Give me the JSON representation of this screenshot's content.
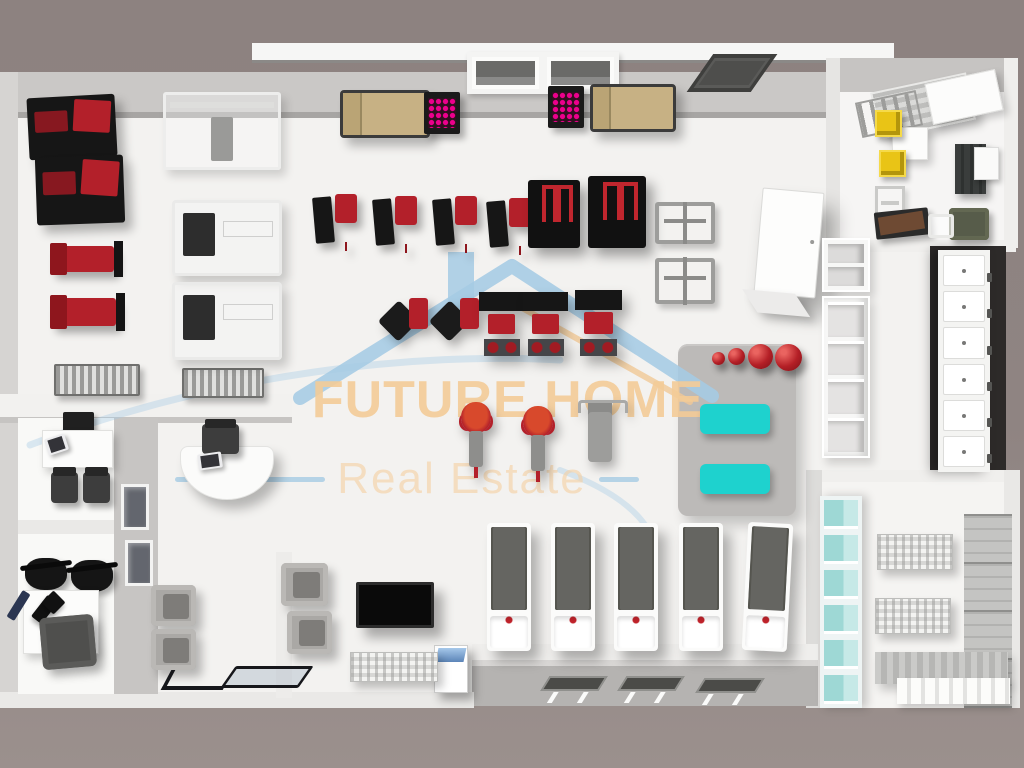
{
  "watermark": {
    "brand": "FUTURE HOME",
    "tagline": "Real Estate",
    "brand_color": "#f3cb97",
    "tagline_color": "#f3d1a3",
    "accent_blue": "#a5cbe4",
    "roof_orange": "#f0c896"
  },
  "palette": {
    "background": "#8f8482",
    "floor": "#f3f2f0",
    "wall": "#cac8c6",
    "machine_red": "#b3202a",
    "machine_black": "#161616",
    "sofa_tan": "#c7b184",
    "rack_pink": "#ec008c",
    "mat_teal": "#1ed2ce",
    "ball_red": "#b41f26",
    "locker_white": "#f4f4f2",
    "bin_yellow": "#e9c416"
  },
  "items": [
    {
      "k": "rect",
      "n": "top-wall",
      "x": 0,
      "y": 72,
      "w": 838,
      "h": 46,
      "c": "#cac8c6"
    },
    {
      "k": "rect",
      "n": "top-wall-edge",
      "x": 18,
      "y": 112,
      "w": 820,
      "h": 7,
      "c": "#a7a5a3"
    },
    {
      "k": "rect",
      "n": "roof-beam",
      "x": 252,
      "y": 43,
      "w": 642,
      "h": 17,
      "c": "#f6f6f5"
    },
    {
      "k": "rect",
      "n": "roof-beam-line",
      "x": 252,
      "y": 60,
      "w": 642,
      "h": 3,
      "c": "#8b8987"
    },
    {
      "k": "rect",
      "n": "left-wall",
      "x": 0,
      "y": 72,
      "w": 18,
      "h": 632,
      "c": "#d6d4d2"
    },
    {
      "k": "rect",
      "n": "main-floor",
      "x": 18,
      "y": 118,
      "w": 988,
      "h": 588,
      "c": "#f3f2f0"
    },
    {
      "k": "rect",
      "n": "office-top-wall",
      "x": 838,
      "y": 58,
      "w": 176,
      "h": 34,
      "c": "#c6c4c2"
    },
    {
      "k": "rect",
      "n": "office-left-wall",
      "x": 826,
      "y": 58,
      "w": 14,
      "h": 190,
      "c": "#e6e5e3"
    },
    {
      "k": "rect",
      "n": "office-floor",
      "x": 840,
      "y": 92,
      "w": 164,
      "h": 148,
      "c": "#f6f5f4"
    },
    {
      "k": "rect",
      "n": "office-right-wall",
      "x": 1004,
      "y": 58,
      "w": 14,
      "h": 190,
      "c": "#efeeec"
    },
    {
      "k": "rect",
      "n": "office-bottom-wall",
      "x": 826,
      "y": 240,
      "w": 190,
      "h": 12,
      "c": "#f0efed"
    },
    {
      "k": "rect",
      "n": "locker-backdrop",
      "x": 930,
      "y": 246,
      "w": 76,
      "h": 228,
      "c": "#2d2a29"
    },
    {
      "k": "rect",
      "n": "changing-left-wall",
      "x": 806,
      "y": 470,
      "w": 16,
      "h": 238,
      "c": "#dddcda"
    },
    {
      "k": "rect",
      "n": "changing-top-wall",
      "x": 822,
      "y": 470,
      "w": 182,
      "h": 12,
      "c": "#f0efed"
    },
    {
      "k": "rect",
      "n": "changing-floor",
      "x": 822,
      "y": 482,
      "w": 182,
      "h": 226,
      "c": "#f5f4f2"
    },
    {
      "k": "rect",
      "n": "changing-right-wall",
      "x": 1004,
      "y": 470,
      "w": 16,
      "h": 238,
      "c": "#e9e8e6"
    },
    {
      "k": "rect",
      "n": "hall-bottom-band",
      "x": 472,
      "y": 644,
      "w": 346,
      "h": 18,
      "c": "#efeeec"
    },
    {
      "k": "rect",
      "n": "recessed-strip",
      "x": 472,
      "y": 660,
      "w": 346,
      "h": 46,
      "c": "#b5b3b1"
    },
    {
      "k": "rect",
      "n": "recessed-strip-bevel",
      "x": 472,
      "y": 660,
      "w": 346,
      "h": 6,
      "c": "#d9d7d5"
    },
    {
      "k": "rect",
      "n": "bottom-ledge",
      "x": 0,
      "y": 692,
      "w": 474,
      "h": 16,
      "c": "#eae9e7"
    },
    {
      "k": "rect",
      "n": "partition-band",
      "x": 0,
      "y": 394,
      "w": 292,
      "h": 24,
      "c": "#f2f1ef"
    },
    {
      "k": "rect",
      "n": "partition-band-shadow",
      "x": 0,
      "y": 417,
      "w": 292,
      "h": 6,
      "c": "#c6c4c2"
    },
    {
      "k": "rect",
      "n": "office-rooms-floor",
      "x": 18,
      "y": 418,
      "w": 96,
      "h": 276,
      "c": "#f9f9f7"
    },
    {
      "k": "rect",
      "n": "glass-wall",
      "x": 114,
      "y": 418,
      "w": 44,
      "h": 276,
      "c": "#c7c5c3"
    },
    {
      "k": "rect",
      "n": "rooms-divider-wall",
      "x": 18,
      "y": 520,
      "w": 96,
      "h": 14,
      "c": "#eae9e7"
    },
    {
      "k": "rect",
      "n": "lounge-wall",
      "x": 276,
      "y": 552,
      "w": 16,
      "h": 146,
      "c": "#edecea"
    },
    {
      "k": "bench-machine",
      "n": "incline-press-machine-1",
      "x": 28,
      "y": 96,
      "w": 88,
      "h": 62,
      "r": -3
    },
    {
      "k": "bench-machine",
      "n": "incline-press-machine-2",
      "x": 36,
      "y": 156,
      "w": 88,
      "h": 68,
      "r": -2
    },
    {
      "k": "bench-red",
      "n": "flat-bench-1",
      "x": 50,
      "y": 246,
      "w": 64,
      "h": 26
    },
    {
      "k": "bench-red",
      "n": "flat-bench-2",
      "x": 50,
      "y": 298,
      "w": 66,
      "h": 28
    },
    {
      "k": "db-rack",
      "n": "dumbbell-rack-1",
      "x": 54,
      "y": 364,
      "w": 86,
      "h": 32
    },
    {
      "k": "db-rack",
      "n": "dumbbell-rack-2",
      "x": 182,
      "y": 368,
      "w": 82,
      "h": 30
    },
    {
      "k": "multi-station",
      "n": "cable-crossover-station",
      "x": 163,
      "y": 92,
      "w": 118,
      "h": 78
    },
    {
      "k": "white-machine",
      "n": "plate-loaded-machine-1",
      "x": 172,
      "y": 200,
      "w": 110,
      "h": 76
    },
    {
      "k": "white-machine",
      "n": "plate-loaded-machine-2",
      "x": 172,
      "y": 282,
      "w": 110,
      "h": 78
    },
    {
      "k": "sofa-tan",
      "n": "lounge-sofa-1",
      "x": 340,
      "y": 90,
      "w": 90,
      "h": 48
    },
    {
      "k": "pink-rack",
      "n": "pink-dumbbell-rack-1",
      "x": 424,
      "y": 92,
      "w": 36,
      "h": 42
    },
    {
      "k": "window-top",
      "n": "top-wall-window",
      "x": 467,
      "y": 52,
      "w": 152,
      "h": 42,
      "cells": 2
    },
    {
      "k": "pink-rack",
      "n": "pink-dumbbell-rack-2",
      "x": 548,
      "y": 86,
      "w": 36,
      "h": 42
    },
    {
      "k": "sofa-tan",
      "n": "lounge-sofa-2",
      "x": 590,
      "y": 84,
      "w": 86,
      "h": 48
    },
    {
      "k": "vent",
      "n": "ceiling-vent",
      "x": 700,
      "y": 54,
      "w": 64,
      "h": 38
    },
    {
      "k": "machine-red-seat",
      "n": "selectorized-machine-1",
      "x": 314,
      "y": 194,
      "w": 46,
      "h": 56
    },
    {
      "k": "machine-red-seat",
      "n": "selectorized-machine-2",
      "x": 374,
      "y": 196,
      "w": 46,
      "h": 56
    },
    {
      "k": "machine-red-seat",
      "n": "selectorized-machine-3",
      "x": 434,
      "y": 196,
      "w": 46,
      "h": 56
    },
    {
      "k": "machine-red-seat",
      "n": "selectorized-machine-4",
      "x": 488,
      "y": 198,
      "w": 46,
      "h": 56
    },
    {
      "k": "machine-black",
      "n": "lat-pulldown-machine",
      "x": 528,
      "y": 180,
      "w": 52,
      "h": 68
    },
    {
      "k": "machine-black",
      "n": "assisted-dip-machine",
      "x": 588,
      "y": 176,
      "w": 58,
      "h": 72
    },
    {
      "k": "fly-machine",
      "n": "pec-fly-machine-1",
      "x": 381,
      "y": 296,
      "w": 52,
      "h": 54
    },
    {
      "k": "fly-machine",
      "n": "pec-fly-machine-2",
      "x": 432,
      "y": 296,
      "w": 52,
      "h": 54
    },
    {
      "k": "rack-bench",
      "n": "squat-rack-bench-1",
      "x": 479,
      "y": 292,
      "w": 45,
      "h": 64
    },
    {
      "k": "rack-bench",
      "n": "squat-rack-bench-2",
      "x": 523,
      "y": 292,
      "w": 45,
      "h": 64
    },
    {
      "k": "rack-bench",
      "n": "squat-rack-bench-3",
      "x": 575,
      "y": 290,
      "w": 47,
      "h": 66
    },
    {
      "k": "pullup-frame",
      "n": "pullup-frame-1",
      "x": 655,
      "y": 202,
      "w": 60,
      "h": 42
    },
    {
      "k": "pullup-frame",
      "n": "pullup-frame-2",
      "x": 655,
      "y": 258,
      "w": 60,
      "h": 46
    },
    {
      "k": "wardrobe-white",
      "n": "storage-cabinet-white",
      "x": 758,
      "y": 190,
      "w": 62,
      "h": 106,
      "r": 5
    },
    {
      "k": "shelf-open-upper",
      "n": "wall-shelf-upper",
      "x": 822,
      "y": 238,
      "w": 48,
      "h": 54,
      "cells": 2
    },
    {
      "k": "shelf-open",
      "n": "open-shelf-unit",
      "x": 822,
      "y": 296,
      "w": 48,
      "h": 162,
      "cells": 4
    },
    {
      "k": "platform",
      "n": "stretching-platform",
      "x": 678,
      "y": 344,
      "w": 118,
      "h": 172,
      "z": 4
    },
    {
      "k": "ball-red",
      "n": "medicine-ball-small-1",
      "x": 712,
      "y": 352,
      "w": 13,
      "h": 13
    },
    {
      "k": "ball-red",
      "n": "medicine-ball-small-2",
      "x": 728,
      "y": 348,
      "w": 17,
      "h": 17
    },
    {
      "k": "ball-red",
      "n": "exercise-ball-large-1",
      "x": 748,
      "y": 344,
      "w": 25,
      "h": 25
    },
    {
      "k": "ball-red",
      "n": "exercise-ball-large-2",
      "x": 775,
      "y": 344,
      "w": 27,
      "h": 27
    },
    {
      "k": "teal-mat",
      "n": "exercise-mat-teal-1",
      "x": 700,
      "y": 404,
      "w": 70,
      "h": 30
    },
    {
      "k": "teal-mat",
      "n": "exercise-mat-teal-2",
      "x": 700,
      "y": 464,
      "w": 70,
      "h": 30
    },
    {
      "k": "spin-bike",
      "n": "spin-bike-1",
      "x": 454,
      "y": 402,
      "w": 44,
      "h": 68
    },
    {
      "k": "spin-bike",
      "n": "spin-bike-2",
      "x": 516,
      "y": 406,
      "w": 44,
      "h": 68
    },
    {
      "k": "elliptical",
      "n": "elliptical-trainer",
      "x": 576,
      "y": 398,
      "w": 48,
      "h": 84
    },
    {
      "k": "treadmill",
      "n": "treadmill-1",
      "x": 487,
      "y": 523,
      "w": 44,
      "h": 128
    },
    {
      "k": "treadmill",
      "n": "treadmill-2",
      "x": 551,
      "y": 523,
      "w": 44,
      "h": 128
    },
    {
      "k": "treadmill",
      "n": "treadmill-3",
      "x": 614,
      "y": 523,
      "w": 44,
      "h": 128
    },
    {
      "k": "treadmill",
      "n": "treadmill-4",
      "x": 679,
      "y": 523,
      "w": 44,
      "h": 128
    },
    {
      "k": "treadmill",
      "n": "treadmill-5",
      "x": 745,
      "y": 523,
      "w": 45,
      "h": 128,
      "r": 3
    },
    {
      "k": "mat-dark",
      "n": "floor-mat-dark-1",
      "x": 545,
      "y": 676,
      "w": 58,
      "h": 15
    },
    {
      "k": "mat-dark",
      "n": "floor-mat-dark-2",
      "x": 622,
      "y": 676,
      "w": 58,
      "h": 15
    },
    {
      "k": "mat-dark",
      "n": "floor-mat-dark-3",
      "x": 700,
      "y": 678,
      "w": 60,
      "h": 15
    },
    {
      "k": "kiosk",
      "n": "check-in-kiosk",
      "x": 434,
      "y": 645,
      "w": 34,
      "h": 48
    },
    {
      "k": "striped",
      "n": "striped-bench-hall",
      "x": 350,
      "y": 652,
      "w": 88,
      "h": 30
    },
    {
      "k": "tv",
      "n": "wall-tv",
      "x": 356,
      "y": 582,
      "w": 78,
      "h": 46
    },
    {
      "k": "armchair-gray",
      "n": "waiting-armchair-1",
      "x": 151,
      "y": 585,
      "w": 45,
      "h": 41
    },
    {
      "k": "armchair-gray",
      "n": "waiting-armchair-2",
      "x": 151,
      "y": 629,
      "w": 45,
      "h": 41
    },
    {
      "k": "armchair-gray",
      "n": "waiting-armchair-3",
      "x": 281,
      "y": 563,
      "w": 47,
      "h": 43
    },
    {
      "k": "armchair-gray",
      "n": "waiting-armchair-4",
      "x": 287,
      "y": 611,
      "w": 45,
      "h": 43
    },
    {
      "k": "curved-desk",
      "n": "reception-desk",
      "x": 180,
      "y": 446,
      "w": 94,
      "h": 54
    },
    {
      "k": "chair-dark",
      "n": "reception-chair",
      "x": 202,
      "y": 424,
      "w": 37,
      "h": 30
    },
    {
      "k": "laptop",
      "n": "reception-laptop",
      "x": 198,
      "y": 453,
      "w": 24,
      "h": 16,
      "r": -8,
      "z": 11
    },
    {
      "k": "printer",
      "n": "office-printer",
      "x": 63,
      "y": 412,
      "w": 31,
      "h": 21
    },
    {
      "k": "desk-white",
      "n": "office-a-desk",
      "x": 42,
      "y": 430,
      "w": 71,
      "h": 38
    },
    {
      "k": "laptop",
      "n": "office-a-laptop",
      "x": 46,
      "y": 436,
      "w": 21,
      "h": 17,
      "r": -18,
      "z": 11
    },
    {
      "k": "chair-dark",
      "n": "office-a-chair-1",
      "x": 51,
      "y": 472,
      "w": 27,
      "h": 31
    },
    {
      "k": "chair-dark",
      "n": "office-a-chair-2",
      "x": 83,
      "y": 472,
      "w": 27,
      "h": 31
    },
    {
      "k": "glass-display",
      "n": "glass-display-case-1",
      "x": 121,
      "y": 484,
      "w": 28,
      "h": 46,
      "z": 11
    },
    {
      "k": "glass-display",
      "n": "glass-display-case-2",
      "x": 125,
      "y": 540,
      "w": 28,
      "h": 46,
      "z": 11
    },
    {
      "k": "chair-black",
      "n": "office-b-chair-1",
      "x": 25,
      "y": 558,
      "w": 42,
      "h": 32
    },
    {
      "k": "chair-black",
      "n": "office-b-chair-2",
      "x": 71,
      "y": 560,
      "w": 42,
      "h": 32
    },
    {
      "k": "desk-white",
      "n": "office-b-desk",
      "x": 23,
      "y": 590,
      "w": 76,
      "h": 64
    },
    {
      "k": "black-item",
      "n": "desk-phone",
      "x": 38,
      "y": 596,
      "w": 13,
      "h": 27,
      "r": 38,
      "z": 11
    },
    {
      "k": "black-item",
      "n": "desk-tablet",
      "x": 45,
      "y": 594,
      "w": 17,
      "h": 17,
      "r": 45,
      "z": 11
    },
    {
      "k": "pen-blue",
      "n": "desk-pen",
      "x": 14,
      "y": 590,
      "w": 9,
      "h": 31,
      "r": 32,
      "z": 11
    },
    {
      "k": "sofa-dark",
      "n": "office-b-sofa",
      "x": 41,
      "y": 616,
      "w": 54,
      "h": 52,
      "r": -5,
      "z": 11
    },
    {
      "k": "entrance-glass",
      "n": "entrance-glass-door",
      "x": 228,
      "y": 666,
      "w": 78,
      "h": 22
    },
    {
      "k": "door-arm",
      "n": "entrance-door-frame",
      "x": 166,
      "y": 670,
      "w": 62,
      "h": 20
    },
    {
      "k": "shelf-gray-top",
      "n": "office-shelf-rack",
      "x": 874,
      "y": 82,
      "w": 98,
      "h": 48,
      "r": -12
    },
    {
      "k": "desk-white",
      "n": "office-whiteboard",
      "x": 928,
      "y": 76,
      "w": 72,
      "h": 42,
      "r": -12,
      "z": 11
    },
    {
      "k": "ladder",
      "n": "office-ladder-rack",
      "x": 858,
      "y": 96,
      "w": 62,
      "h": 36,
      "r": -12
    },
    {
      "k": "box-yellow",
      "n": "yellow-bin-1",
      "x": 875,
      "y": 110,
      "w": 27,
      "h": 27,
      "z": 11
    },
    {
      "k": "desk-white",
      "n": "office-side-table",
      "x": 892,
      "y": 127,
      "w": 36,
      "h": 33
    },
    {
      "k": "box-yellow",
      "n": "yellow-bin-2",
      "x": 879,
      "y": 150,
      "w": 27,
      "h": 27,
      "z": 11
    },
    {
      "k": "rack-small",
      "n": "small-rack",
      "x": 875,
      "y": 186,
      "w": 30,
      "h": 38
    },
    {
      "k": "cabinet-dark",
      "n": "dark-cabinet",
      "x": 955,
      "y": 144,
      "w": 31,
      "h": 50
    },
    {
      "k": "box-white",
      "n": "white-cabinet-box",
      "x": 974,
      "y": 147,
      "w": 25,
      "h": 33,
      "z": 11
    },
    {
      "k": "desk-brown",
      "n": "manager-desk",
      "x": 875,
      "y": 210,
      "w": 54,
      "h": 27,
      "r": -6
    },
    {
      "k": "chair-olive",
      "n": "manager-chair",
      "x": 949,
      "y": 208,
      "w": 40,
      "h": 32
    },
    {
      "k": "chair-white-sm",
      "n": "guest-chair",
      "x": 928,
      "y": 214,
      "w": 26,
      "h": 24,
      "z": 11
    },
    {
      "k": "locker-col",
      "n": "locker-bank",
      "x": 938,
      "y": 250,
      "w": 52,
      "h": 222,
      "cells": 6
    },
    {
      "k": "teal-col",
      "n": "teal-shelf-column",
      "x": 820,
      "y": 496,
      "w": 42,
      "h": 212,
      "cells": 6
    },
    {
      "k": "striped",
      "n": "towel-shelf-1",
      "x": 877,
      "y": 534,
      "w": 76,
      "h": 36
    },
    {
      "k": "striped",
      "n": "towel-shelf-2",
      "x": 875,
      "y": 598,
      "w": 76,
      "h": 36
    },
    {
      "k": "gray-stack",
      "n": "slatted-locker-stack",
      "x": 964,
      "y": 514,
      "w": 48,
      "h": 194
    },
    {
      "k": "corner-bench",
      "n": "changing-corner-bench",
      "x": 875,
      "y": 652,
      "w": 133,
      "h": 32
    },
    {
      "k": "white-slats",
      "n": "changing-bench-slats",
      "x": 897,
      "y": 678,
      "w": 113,
      "h": 26,
      "z": 11
    }
  ]
}
